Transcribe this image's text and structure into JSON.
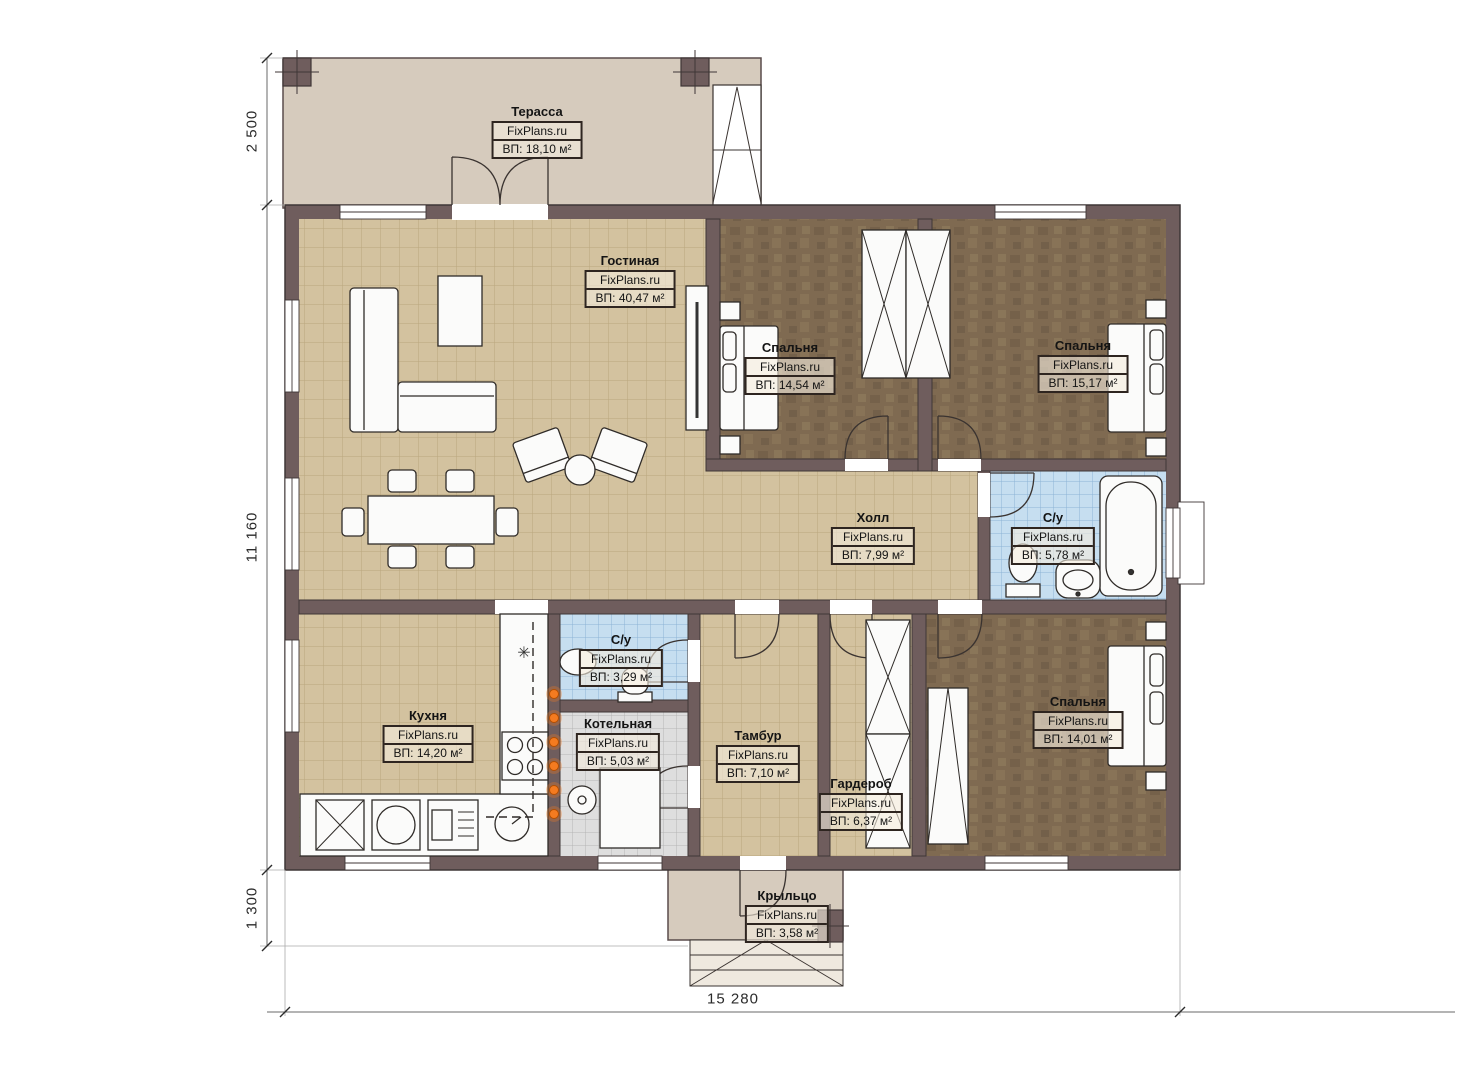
{
  "plan": {
    "brand": "FixPlans.ru",
    "rooms": [
      {
        "name": "Терасса",
        "area": "ВП: 18,10 м²"
      },
      {
        "name": "Гостиная",
        "area": "ВП: 40,47 м²"
      },
      {
        "name": "Спальня",
        "area": "ВП: 14,54 м²"
      },
      {
        "name": "Спальня",
        "area": "ВП: 15,17 м²"
      },
      {
        "name": "Холл",
        "area": "ВП: 7,99 м²"
      },
      {
        "name": "С/у",
        "area": "ВП: 5,78 м²"
      },
      {
        "name": "Кухня",
        "area": "ВП: 14,20 м²"
      },
      {
        "name": "С/у",
        "area": "ВП: 3,29 м²"
      },
      {
        "name": "Котельная",
        "area": "ВП: 5,03 м²"
      },
      {
        "name": "Тамбур",
        "area": "ВП: 7,10 м²"
      },
      {
        "name": "Гардероб",
        "area": "ВП: 6,37 м²"
      },
      {
        "name": "Спальня",
        "area": "ВП: 14,01 м²"
      },
      {
        "name": "Крыльцо",
        "area": "ВП: 3,58 м²"
      }
    ],
    "dimensions": {
      "terrace_depth": "2 500",
      "house_depth": "11 160",
      "porch_depth": "1 300",
      "house_width": "15 280"
    },
    "icons": {
      "fridge": "✳"
    },
    "colors": {
      "wall": "#6f5d5d",
      "tile_beige": "#d3c29f",
      "floor_brown": "#7f6a51",
      "tile_blue": "#c6def0",
      "tile_gray": "#dedede",
      "terrace": "#d6cbbd",
      "marker_orange": "#f47b20"
    }
  }
}
